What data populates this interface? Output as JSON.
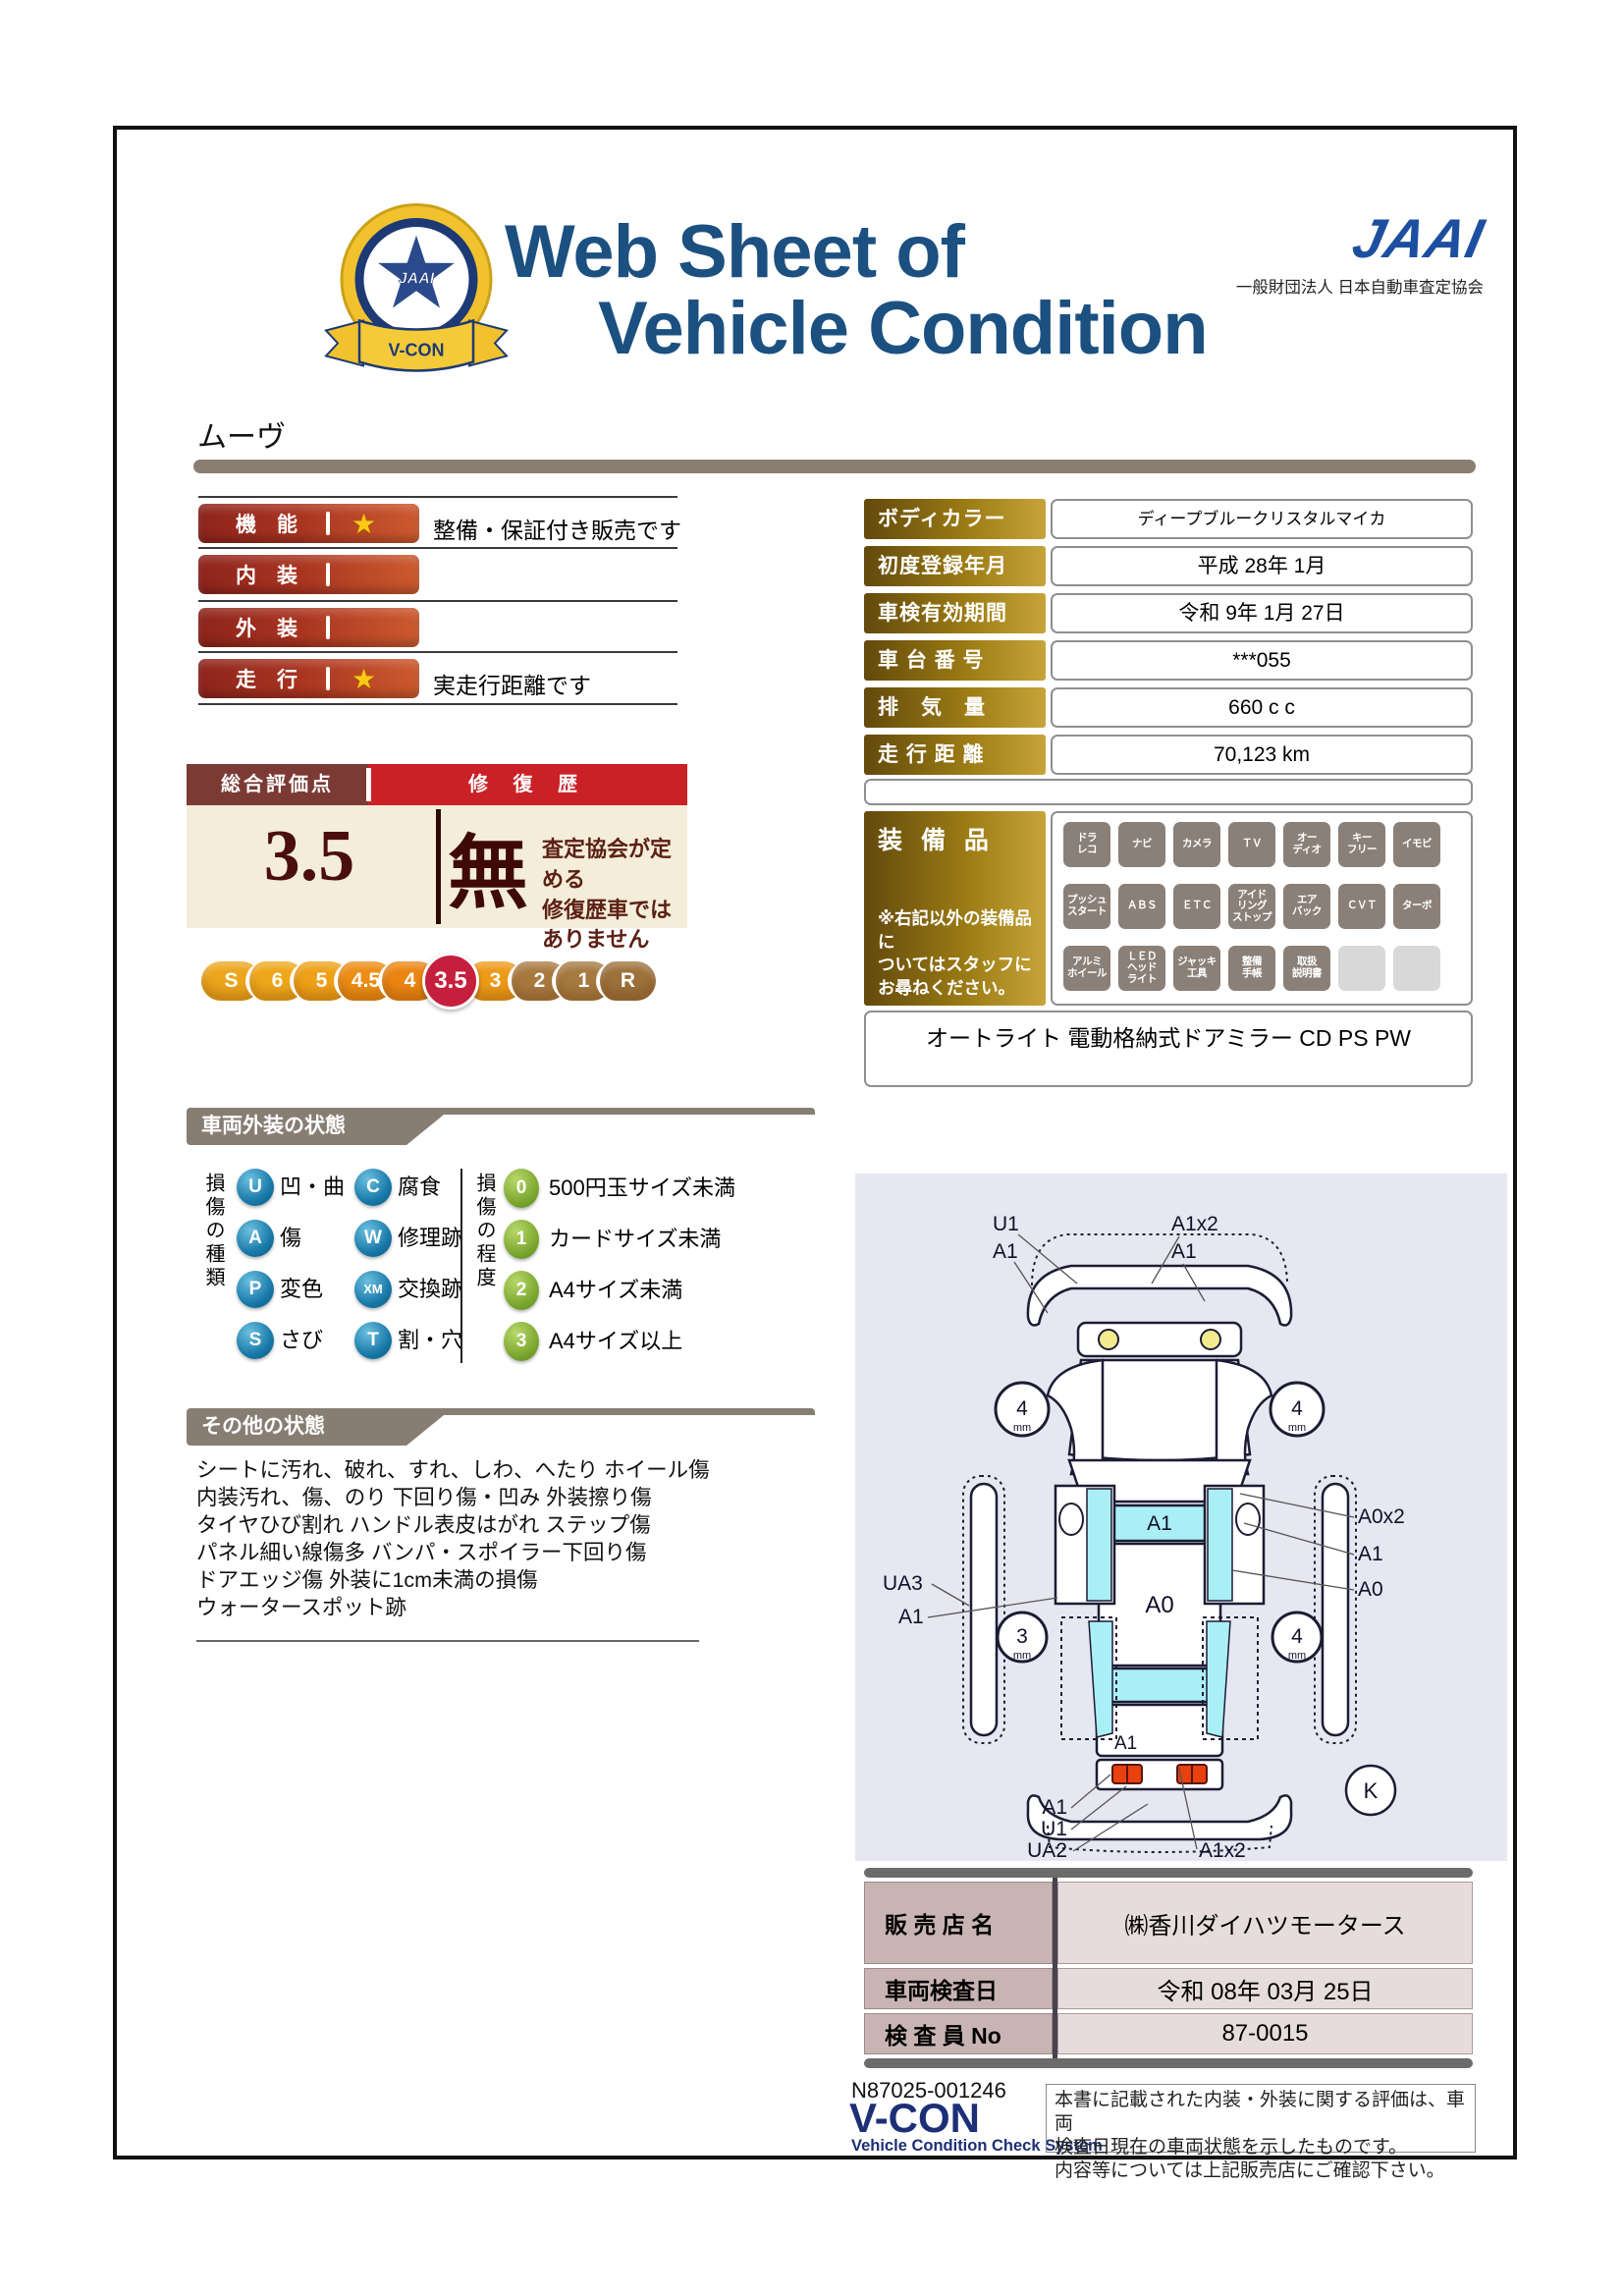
{
  "header": {
    "badge": {
      "org": "JAAI",
      "ring_text": "VEHICLE CONDITION CHECK SYSTEM",
      "ribbon": "V-CON"
    },
    "title_line1": "Web Sheet of",
    "title_line2": "Vehicle Condition",
    "jaai_logo": "JAAI",
    "jaai_subtitle": "一般財団法人 日本自動車査定協会"
  },
  "model_name": "ムーヴ",
  "ratings": {
    "star": "★",
    "rows": [
      {
        "label": "機　能",
        "has_star": true,
        "note": "整備・保証付き販売です"
      },
      {
        "label": "内　装",
        "has_star": false,
        "note": ""
      },
      {
        "label": "外　装",
        "has_star": false,
        "note": ""
      },
      {
        "label": "走　行",
        "has_star": true,
        "note": "実走行距離です"
      }
    ]
  },
  "overall": {
    "score_label": "総合評価点",
    "score": "3.5",
    "repair_label": "修 復 歴",
    "repair_value": "無",
    "repair_note": "査定協会が定める\n修復歴車ではありません"
  },
  "scale": {
    "items": [
      {
        "label": "S",
        "color": "#eca61b",
        "selected": false
      },
      {
        "label": "6",
        "color": "#efa71a",
        "selected": false
      },
      {
        "label": "5",
        "color": "#eea117",
        "selected": false
      },
      {
        "label": "4.5",
        "color": "#ec8d14",
        "selected": false
      },
      {
        "label": "4",
        "color": "#eb8512",
        "selected": false
      },
      {
        "label": "3.5",
        "color": "#c61f3e",
        "selected": true
      },
      {
        "label": "3",
        "color": "#ec9a17",
        "selected": false
      },
      {
        "label": "2",
        "color": "#a8793f",
        "selected": false
      },
      {
        "label": "1",
        "color": "#a57940",
        "selected": false
      },
      {
        "label": "R",
        "color": "#9c713a",
        "selected": false
      }
    ]
  },
  "info_table": {
    "rows": [
      {
        "label": "ボディカラー",
        "value": "ディープブルークリスタルマイカ"
      },
      {
        "label": "初度登録年月",
        "value": "平成 28年 1月"
      },
      {
        "label": "車検有効期間",
        "value": "令和 9年 1月 27日"
      },
      {
        "label": "車 台 番 号",
        "value": "***055"
      },
      {
        "label": "排　気　量",
        "value": "660 c c"
      },
      {
        "label": "走 行 距 離",
        "value": "70,123 km"
      }
    ]
  },
  "equipment": {
    "label": "装 備 品",
    "note": "※右記以外の装備品に\nついてはスタッフに\nお尋ねください。",
    "badges": [
      {
        "label": "ドラ\nレコ",
        "active": true
      },
      {
        "label": "ナビ",
        "active": true
      },
      {
        "label": "カメラ",
        "active": true
      },
      {
        "label": "ＴＶ",
        "active": true
      },
      {
        "label": "オー\nディオ",
        "active": true
      },
      {
        "label": "キー\nフリー",
        "active": true
      },
      {
        "label": "イモビ",
        "active": true
      },
      {
        "label": "プッシュ\nスタート",
        "active": true
      },
      {
        "label": "ＡＢＳ",
        "active": true
      },
      {
        "label": "ＥＴＣ",
        "active": true
      },
      {
        "label": "アイド\nリング\nストップ",
        "active": true
      },
      {
        "label": "エア\nバック",
        "active": true
      },
      {
        "label": "ＣＶＴ",
        "active": true
      },
      {
        "label": "ターボ",
        "active": true
      },
      {
        "label": "アルミ\nホイール",
        "active": true
      },
      {
        "label": "ＬＥＤ\nヘッド\nライト",
        "active": true
      },
      {
        "label": "ジャッキ\n工具",
        "active": true
      },
      {
        "label": "整備\n手帳",
        "active": true
      },
      {
        "label": "取扱\n説明書",
        "active": true
      },
      {
        "label": "",
        "active": false
      },
      {
        "label": "",
        "active": false
      }
    ],
    "extra": "オートライト 電動格納式ドアミラー CD PS PW"
  },
  "exterior_section": {
    "title": "車両外装の状態",
    "kind_axis": "損傷の種類",
    "degree_axis": "損傷の程度",
    "kinds": [
      {
        "code": "U",
        "label": "凹・曲"
      },
      {
        "code": "C",
        "label": "腐食"
      },
      {
        "code": "A",
        "label": "傷"
      },
      {
        "code": "W",
        "label": "修理跡"
      },
      {
        "code": "P",
        "label": "変色"
      },
      {
        "code": "XM",
        "label": "交換跡"
      },
      {
        "code": "S",
        "label": "さび"
      },
      {
        "code": "T",
        "label": "割・穴"
      }
    ],
    "degrees": [
      {
        "code": "0",
        "label": "500円玉サイズ未満"
      },
      {
        "code": "1",
        "label": "カードサイズ未満"
      },
      {
        "code": "2",
        "label": "A4サイズ未満"
      },
      {
        "code": "3",
        "label": "A4サイズ以上"
      }
    ]
  },
  "other_section": {
    "title": "その他の状態",
    "lines": [
      "シートに汚れ、破れ、すれ、しわ、へたり ホイール傷",
      "内装汚れ、傷、のり 下回り傷・凹み 外装擦り傷",
      "タイヤひび割れ ハンドル表皮はがれ ステップ傷",
      "パネル細い線傷多 バンパ・スポイラー下回り傷",
      "ドアエッジ傷 外装に1cm未満の損傷",
      "ウォータースポット跡"
    ]
  },
  "diagram": {
    "top_left_labels": [
      "U1",
      "A1"
    ],
    "top_right_labels": [
      "A1x2",
      "A1"
    ],
    "left_labels": [
      "UA3",
      "A1"
    ],
    "right_labels": [
      "A0x2",
      "A1",
      "A0"
    ],
    "bottom_left_labels": [
      "A1",
      "U1",
      "UA2"
    ],
    "bottom_right_label": "A1x2",
    "windshield_label": "A1",
    "roof_label": "A0",
    "trunk_label": "A1",
    "corner_mark": "K",
    "wheels": {
      "front_left": "4",
      "front_right": "4",
      "rear_left": "3",
      "rear_right": "4",
      "unit": "mm"
    }
  },
  "dealer_table": {
    "rows": [
      {
        "label": "販 売 店 名",
        "value": "㈱香川ダイハツモータース"
      },
      {
        "label": "車両検査日",
        "value": "令和 08年 03月 25日"
      },
      {
        "label": "検 査 員 No",
        "value": "87-0015"
      }
    ]
  },
  "footer": {
    "serial": "N87025-001246",
    "vcon": "V-CON",
    "vcon_sub": "Vehicle Condition Check System",
    "disclaimer": "本書に記載された内装・外装に関する評価は、車両\n検査日現在の車両状態を示したものです。\n内容等については上記販売店にご確認下さい。"
  },
  "colors": {
    "title_navy": "#1b5080",
    "gold_dark": "#63490c",
    "gold_light": "#c7a43a",
    "rating_bar_dark": "#8e241c",
    "rating_bar_light": "#cc5a2e",
    "repair_red": "#ca2127",
    "score_bg_cream": "#f3edd9",
    "selected_grade_red": "#c61f3e",
    "diagram_bg": "#e7e7f2",
    "diagram_cyan": "#abeff6",
    "dealer_label_pink": "#c9b4b4",
    "dealer_value_pink": "#e7dcdc"
  }
}
